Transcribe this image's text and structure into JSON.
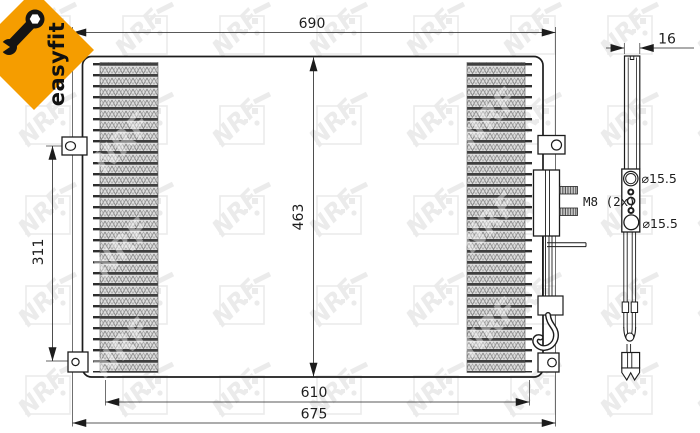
{
  "badge": {
    "label": "easyfit",
    "icon": "wrench-icon",
    "color": "#F59D00"
  },
  "watermark": {
    "text": "NRF"
  },
  "views": {
    "front": {
      "dimensions": {
        "overall_width": "690",
        "core_height": "463",
        "bracket_height": "311",
        "core_width": "610",
        "mounting_width": "675",
        "thread_spec": "M8 (2x)"
      }
    },
    "side": {
      "dimensions": {
        "depth": "16",
        "top_port": "⌀15.5",
        "bottom_port": "⌀15.5"
      }
    }
  },
  "colors": {
    "accent": "#F59D00",
    "line": "#1c1c1c",
    "hatch": "#dedede",
    "watermark": "#ebebeb"
  }
}
